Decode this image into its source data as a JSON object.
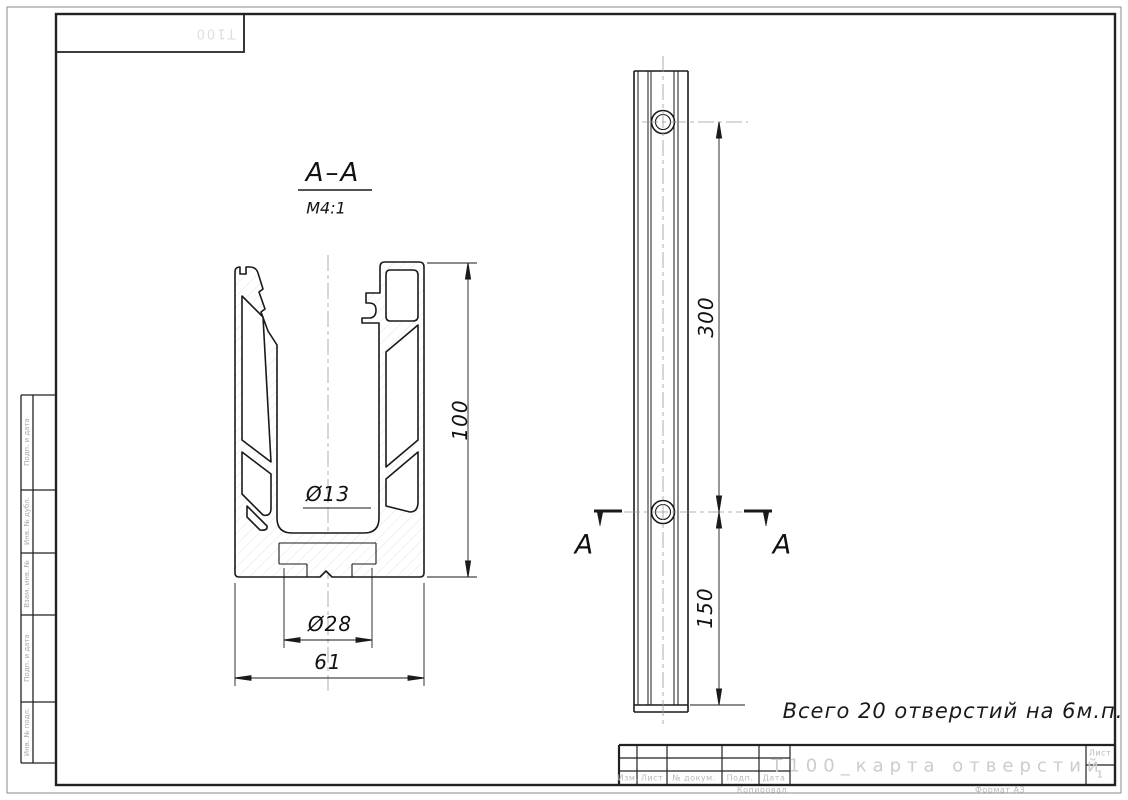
{
  "sheet": {
    "stamp_top": "Т100",
    "margin_labels": [
      "Подп. и дата",
      "Инв. № дубл.",
      "Взам. инв. №",
      "Подп. и дата",
      "Инв. № подл."
    ],
    "footer": {
      "kopiroval": "Копировал",
      "format": "Формат А3"
    }
  },
  "section_view": {
    "title": "А–А",
    "scale": "М4:1",
    "dims": {
      "height": "100",
      "hole_dia": "Ø13",
      "seat_dia": "Ø28",
      "width": "61"
    }
  },
  "side_view": {
    "dims": {
      "hole_spacing": "300",
      "end_offset": "150"
    },
    "section_letter_left": "А",
    "section_letter_right": "А"
  },
  "note": "Всего 20 отверстий на 6м.п.",
  "title_block": {
    "doc_title": "Т100_карта отверстий",
    "labels": {
      "izm": "Изм.",
      "list": "Лист",
      "doc": "№ докум.",
      "podp": "Подп.",
      "data": "Дата"
    },
    "sheet_label": "Лист",
    "sheet_number": "1"
  },
  "colors": {
    "line": "#1a1a1a",
    "ghost_text": "#c7c7c7"
  }
}
